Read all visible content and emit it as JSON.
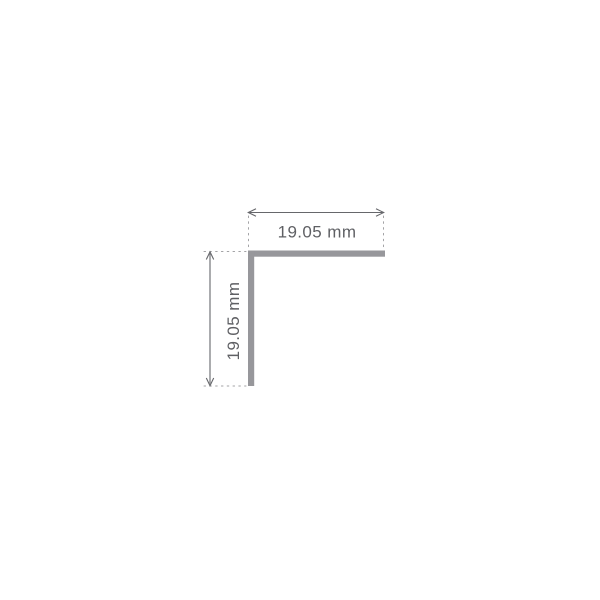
{
  "diagram": {
    "kind": "angle-profile-dimension-drawing",
    "horizontal_dimension": {
      "label": "19.05 mm"
    },
    "vertical_dimension": {
      "label": "19.05 mm"
    }
  },
  "colors": {
    "background": "#ffffff",
    "profile": "#97979b",
    "dimension_line": "#66676b",
    "extension_line": "#a3a3a6",
    "label_text": "#5f6064"
  }
}
